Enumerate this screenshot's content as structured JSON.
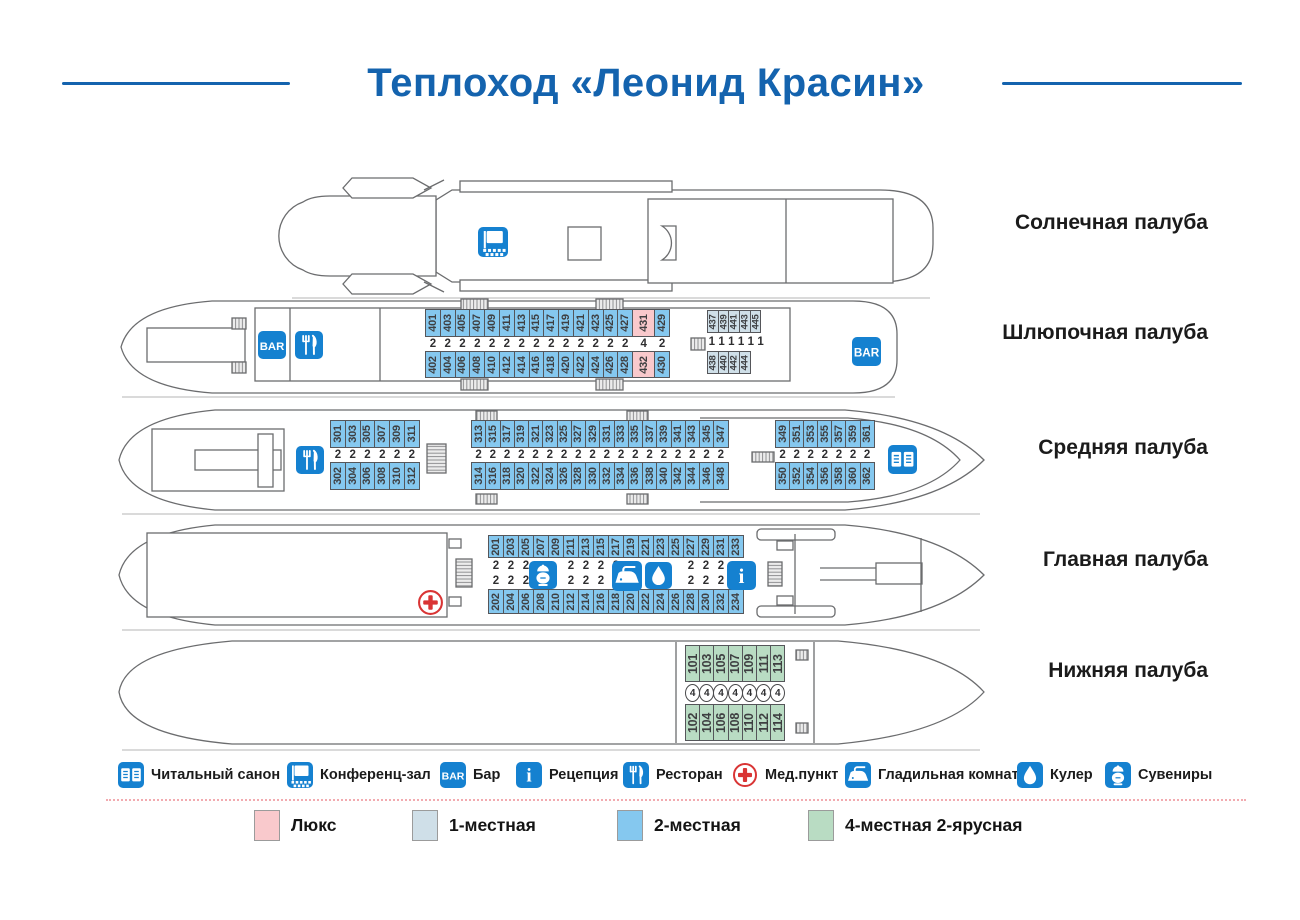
{
  "title": "Теплоход «Леонид Красин»",
  "colors": {
    "accent_blue": "#1581d0",
    "title_blue": "#1463ae",
    "med_red": "#d93434",
    "lux_pink": "#f9c9cc",
    "single_blue": "#cfdfe8",
    "double_blue": "#85c8ef",
    "quad_green": "#b9dcc3"
  },
  "decks": [
    {
      "id": "sun",
      "label": "Солнечная палуба",
      "label_y": 223
    },
    {
      "id": "boat",
      "label": "Шлюпочная палуба",
      "label_y": 333
    },
    {
      "id": "middle",
      "label": "Средняя палуба",
      "label_y": 448
    },
    {
      "id": "main",
      "label": "Главная палуба",
      "label_y": 560
    },
    {
      "id": "lower",
      "label": "Нижняя палуба",
      "label_y": 671
    }
  ],
  "cabin_types": [
    {
      "id": "lux",
      "label": "Люкс",
      "color": "#f9c9cc",
      "x": 254
    },
    {
      "id": "single",
      "label": "1-местная",
      "color": "#cfdfe8",
      "x": 412
    },
    {
      "id": "double",
      "label": "2-местная",
      "color": "#85c8ef",
      "x": 617
    },
    {
      "id": "quad",
      "label": "4-местная 2-ярусная",
      "color": "#b9dcc3",
      "x": 808
    }
  ],
  "facilities": [
    {
      "icon": "book",
      "label": "Читальный санон",
      "x": 118
    },
    {
      "icon": "conference",
      "label": "Конференц-зал",
      "x": 287
    },
    {
      "icon": "bar",
      "label": "Бар",
      "x": 440
    },
    {
      "icon": "info",
      "label": "Рецепция",
      "x": 516
    },
    {
      "icon": "restaurant",
      "label": "Ресторан",
      "x": 623
    },
    {
      "icon": "med",
      "label": "Мед.пункт",
      "x": 732
    },
    {
      "icon": "iron",
      "label": "Гладильная комната",
      "x": 845
    },
    {
      "icon": "cooler",
      "label": "Кулер",
      "x": 1017
    },
    {
      "icon": "souvenirs",
      "label": "Сувениры",
      "x": 1105
    }
  ],
  "deck_icons": [
    {
      "icon": "conference",
      "x": 478,
      "y": 227,
      "s": 30
    },
    {
      "icon": "bar",
      "x": 258,
      "y": 331,
      "s": 28
    },
    {
      "icon": "restaurant",
      "x": 295,
      "y": 331,
      "s": 28
    },
    {
      "icon": "bar",
      "x": 852,
      "y": 337,
      "s": 29
    },
    {
      "icon": "restaurant",
      "x": 296,
      "y": 446,
      "s": 28
    },
    {
      "icon": "book",
      "x": 888,
      "y": 445,
      "s": 29
    },
    {
      "icon": "med",
      "x": 417,
      "y": 589,
      "s": 27
    },
    {
      "icon": "souvenirs",
      "x": 529,
      "y": 561,
      "s": 28
    },
    {
      "icon": "iron",
      "x": 612,
      "y": 561,
      "s": 30
    },
    {
      "icon": "cooler",
      "x": 645,
      "y": 562,
      "s": 27
    },
    {
      "icon": "info",
      "x": 727,
      "y": 561,
      "s": 29
    }
  ],
  "cabin_groups": [
    {
      "id": "boat-main",
      "x": 425,
      "y": 309,
      "col_w": 15.8,
      "wide_w": 23,
      "h": [
        28,
        14,
        27
      ],
      "columns": [
        {
          "t": "401",
          "b": "402",
          "c": "2",
          "k": "double"
        },
        {
          "t": "403",
          "b": "404",
          "c": "2",
          "k": "double"
        },
        {
          "t": "405",
          "b": "406",
          "c": "2",
          "k": "double"
        },
        {
          "t": "407",
          "b": "408",
          "c": "2",
          "k": "double"
        },
        {
          "t": "409",
          "b": "410",
          "c": "2",
          "k": "double"
        },
        {
          "t": "411",
          "b": "412",
          "c": "2",
          "k": "double"
        },
        {
          "t": "413",
          "b": "414",
          "c": "2",
          "k": "double"
        },
        {
          "t": "415",
          "b": "416",
          "c": "2",
          "k": "double"
        },
        {
          "t": "417",
          "b": "418",
          "c": "2",
          "k": "double"
        },
        {
          "t": "419",
          "b": "420",
          "c": "2",
          "k": "double"
        },
        {
          "t": "421",
          "b": "422",
          "c": "2",
          "k": "double"
        },
        {
          "t": "423",
          "b": "424",
          "c": "2",
          "k": "double"
        },
        {
          "t": "425",
          "b": "426",
          "c": "2",
          "k": "double"
        },
        {
          "t": "427",
          "b": "428",
          "c": "2",
          "k": "double"
        },
        {
          "t": "431",
          "b": "432",
          "c": "4",
          "k": "lux",
          "w": true
        },
        {
          "t": "429",
          "b": "430",
          "c": "2",
          "k": "double"
        }
      ]
    },
    {
      "id": "boat-singles",
      "cls": "small",
      "x": 707,
      "y": 310,
      "col_w": 11.7,
      "h": [
        23,
        18,
        23
      ],
      "caps_row": [
        "1",
        "1",
        "1",
        "1",
        "1",
        "1"
      ],
      "columns": [
        {
          "t": "437",
          "b": "438",
          "k": "single"
        },
        {
          "t": "439",
          "b": "440",
          "k": "single"
        },
        {
          "t": "441",
          "b": "442",
          "k": "single"
        },
        {
          "t": "443",
          "b": "444",
          "k": "single"
        },
        {
          "t": "445",
          "b": null,
          "k": "single"
        }
      ]
    },
    {
      "id": "middle-aft",
      "x": 330,
      "y": 420,
      "col_w": 15.8,
      "h": [
        28,
        14,
        28
      ],
      "columns": [
        {
          "t": "301",
          "b": "302",
          "c": "2",
          "k": "double"
        },
        {
          "t": "303",
          "b": "304",
          "c": "2",
          "k": "double"
        },
        {
          "t": "305",
          "b": "306",
          "c": "2",
          "k": "double"
        },
        {
          "t": "307",
          "b": "308",
          "c": "2",
          "k": "double"
        },
        {
          "t": "309",
          "b": "310",
          "c": "2",
          "k": "double"
        },
        {
          "t": "311",
          "b": "312",
          "c": "2",
          "k": "double"
        }
      ]
    },
    {
      "id": "middle-mid",
      "x": 471,
      "y": 420,
      "col_w": 15.25,
      "h": [
        28,
        14,
        28
      ],
      "columns": [
        {
          "t": "313",
          "b": "314",
          "c": "2",
          "k": "double"
        },
        {
          "t": "315",
          "b": "316",
          "c": "2",
          "k": "double"
        },
        {
          "t": "317",
          "b": "318",
          "c": "2",
          "k": "double"
        },
        {
          "t": "319",
          "b": "320",
          "c": "2",
          "k": "double"
        },
        {
          "t": "321",
          "b": "322",
          "c": "2",
          "k": "double"
        },
        {
          "t": "323",
          "b": "324",
          "c": "2",
          "k": "double"
        },
        {
          "t": "325",
          "b": "326",
          "c": "2",
          "k": "double"
        },
        {
          "t": "327",
          "b": "328",
          "c": "2",
          "k": "double"
        },
        {
          "t": "329",
          "b": "330",
          "c": "2",
          "k": "double"
        },
        {
          "t": "331",
          "b": "332",
          "c": "2",
          "k": "double"
        },
        {
          "t": "333",
          "b": "334",
          "c": "2",
          "k": "double"
        },
        {
          "t": "335",
          "b": "336",
          "c": "2",
          "k": "double"
        },
        {
          "t": "337",
          "b": "338",
          "c": "2",
          "k": "double"
        },
        {
          "t": "339",
          "b": "340",
          "c": "2",
          "k": "double"
        },
        {
          "t": "341",
          "b": "342",
          "c": "2",
          "k": "double"
        },
        {
          "t": "343",
          "b": "344",
          "c": "2",
          "k": "double"
        },
        {
          "t": "345",
          "b": "346",
          "c": "2",
          "k": "double"
        },
        {
          "t": "347",
          "b": "348",
          "c": "2",
          "k": "double"
        }
      ]
    },
    {
      "id": "middle-fwd",
      "x": 775,
      "y": 420,
      "col_w": 15.1,
      "h": [
        28,
        14,
        28
      ],
      "columns": [
        {
          "t": "349",
          "b": "350",
          "c": "2",
          "k": "double"
        },
        {
          "t": "351",
          "b": "352",
          "c": "2",
          "k": "double"
        },
        {
          "t": "353",
          "b": "354",
          "c": "2",
          "k": "double"
        },
        {
          "t": "355",
          "b": "356",
          "c": "2",
          "k": "double"
        },
        {
          "t": "357",
          "b": "358",
          "c": "2",
          "k": "double"
        },
        {
          "t": "359",
          "b": "360",
          "c": "2",
          "k": "double"
        },
        {
          "t": "361",
          "b": "362",
          "c": "2",
          "k": "double"
        }
      ]
    },
    {
      "id": "main",
      "x": 488,
      "y": 535,
      "col_w": 16,
      "h": [
        23,
        15,
        16,
        25
      ],
      "two_caps": true,
      "columns": [
        {
          "t": "201",
          "b": "202",
          "c": "2",
          "k": "double"
        },
        {
          "t": "203",
          "b": "204",
          "c": "2",
          "k": "double"
        },
        {
          "t": "205",
          "b": "206",
          "c": "2",
          "k": "double"
        },
        {
          "t": "207",
          "b": "208",
          "c": "",
          "k": "double"
        },
        {
          "t": "209",
          "b": "210",
          "c": "",
          "k": "double"
        },
        {
          "t": "211",
          "b": "212",
          "c": "2",
          "k": "double"
        },
        {
          "t": "213",
          "b": "214",
          "c": "2",
          "k": "double"
        },
        {
          "t": "215",
          "b": "216",
          "c": "2",
          "k": "double"
        },
        {
          "t": "217",
          "b": "218",
          "c": "2",
          "k": "double"
        },
        {
          "t": "219",
          "b": "220",
          "c": "",
          "k": "double"
        },
        {
          "t": "221",
          "b": "222",
          "c": "",
          "k": "double"
        },
        {
          "t": "223",
          "b": "224",
          "c": "",
          "k": "double"
        },
        {
          "t": "225",
          "b": "226",
          "c": "",
          "k": "double"
        },
        {
          "t": "227",
          "b": "228",
          "c": "2",
          "k": "double"
        },
        {
          "t": "229",
          "b": "230",
          "c": "2",
          "k": "double"
        },
        {
          "t": "231",
          "b": "232",
          "c": "2",
          "k": "double"
        },
        {
          "t": "233",
          "b": "234",
          "c": "",
          "k": "double"
        }
      ]
    },
    {
      "id": "lower",
      "cls": "big",
      "x": 685,
      "y": 645,
      "col_w": 15.2,
      "h": [
        37,
        22,
        37
      ],
      "circle": true,
      "columns": [
        {
          "t": "101",
          "b": "102",
          "c": "4",
          "k": "quad"
        },
        {
          "t": "103",
          "b": "104",
          "c": "4",
          "k": "quad"
        },
        {
          "t": "105",
          "b": "106",
          "c": "4",
          "k": "quad"
        },
        {
          "t": "107",
          "b": "108",
          "c": "4",
          "k": "quad"
        },
        {
          "t": "109",
          "b": "110",
          "c": "4",
          "k": "quad"
        },
        {
          "t": "111",
          "b": "112",
          "c": "4",
          "k": "quad"
        },
        {
          "t": "113",
          "b": "114",
          "c": "4",
          "k": "quad"
        }
      ]
    }
  ]
}
